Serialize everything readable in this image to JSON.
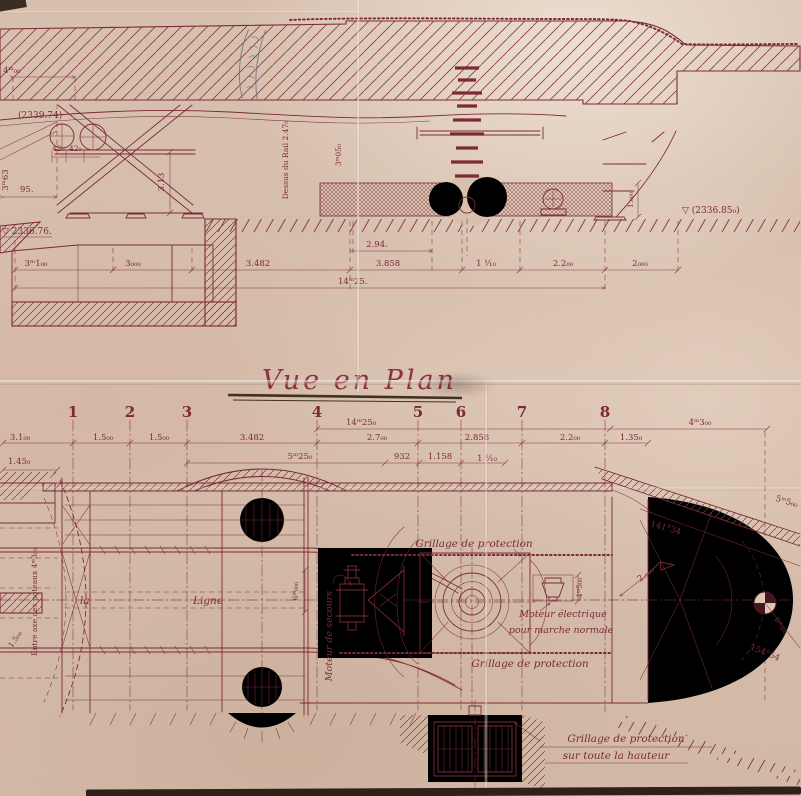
{
  "title": {
    "text": "Vue en Plan"
  },
  "colors": {
    "ink": "#7c2a36",
    "paper": "#d8c0ae",
    "pencil": "#6e747a",
    "underline": "#41311f"
  },
  "elevation": {
    "level_top_left": "(2339.74)",
    "level_bottom_left": "▽ 2336.76.",
    "level_right": "▽ (2336.85₀)",
    "dim_4m": "4ᵐ₀₀",
    "dim_95": "95.",
    "dim_3m63": "3ᵐ63",
    "dim_42_a": "42₀",
    "dim_42_b": "42₀",
    "dim_3_13": "3.13",
    "rail_note": "Dessus du Rail 2.47₀",
    "dim_3m05": "3ᵐ05₀",
    "dim_1m": "1.₀₀₀",
    "dim_2_94": "2.94.",
    "dim_row": [
      "3ᵐ1₀₀",
      "3₀₀₀",
      "3.482",
      "3.858",
      "1 ¹⁄₁₀",
      "2.2₀₀",
      "2₀₀₀"
    ],
    "dim_14m25": "14ᵐ25."
  },
  "plan": {
    "grid": [
      "1",
      "2",
      "3",
      "4",
      "5",
      "6",
      "7",
      "8"
    ],
    "dim_14m25": "14ᵐ25₀",
    "dim_4m3": "4ᵐ3₀₀",
    "dim_row1": [
      "3.1₀₀",
      "1.5₀₀",
      "1.5₀₀",
      "3.482",
      "2.7₀₀",
      "2.858",
      "2.2₀₀",
      "1.35₀"
    ],
    "dim_row2": [
      "5ᵐ25₀",
      "932",
      "1.158",
      "1 ¹⁄₁₀"
    ],
    "dim_1_45": "1.45₀",
    "dim_1_5": "1.5₀₀",
    "entre_axe": "Entre axe des poteaux 4ᵐ3₀₀",
    "dim_6m_v": "6ᵐ₀₀₀",
    "label_la": "la",
    "label_ligne": "Ligne",
    "moteur_secours": "Moteur de secours",
    "grillage_top": "Grillage de protection",
    "grillage_bottom": "Grillage de protection",
    "moteur_elec_1": "Moteur électrique",
    "moteur_elec_2": "pour marche normale",
    "dim_4m5": "4ᵐ5₀₀",
    "radius": "2.₀₀₀",
    "angle_1": "141°34",
    "angle_2": "154°54",
    "dim_5m5": "5ᵐ5₀₀",
    "dim_6m_diag": "6ᵐ₀₀₀",
    "grillage_full_1": "Grillage de protection",
    "grillage_full_2": "sur toute la hauteur"
  }
}
